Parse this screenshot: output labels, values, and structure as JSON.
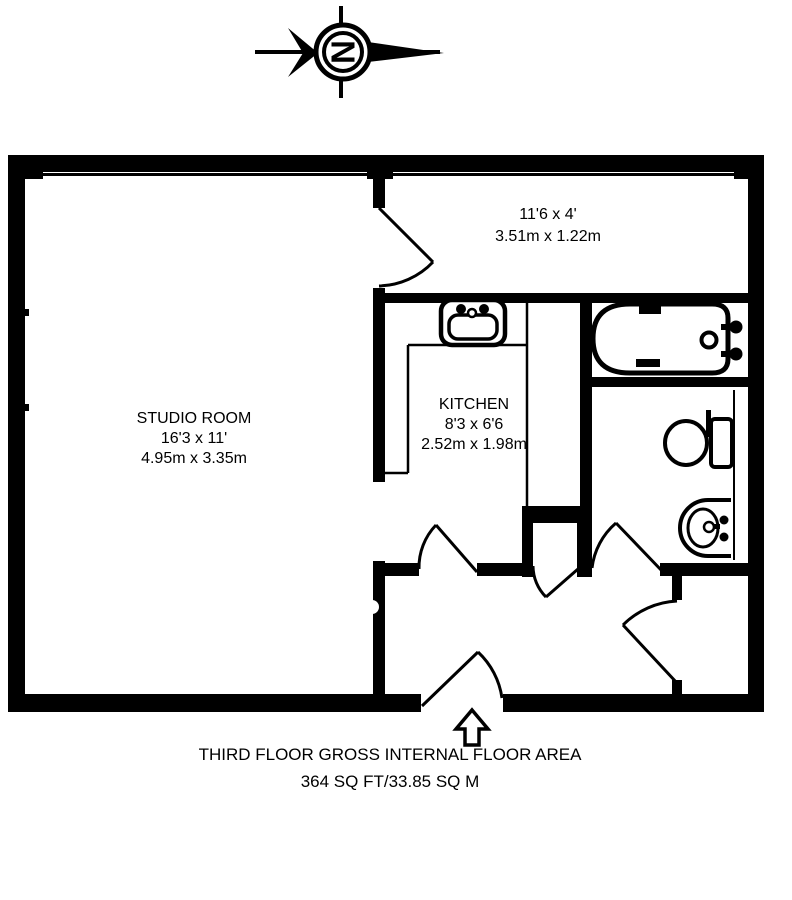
{
  "compass": {
    "letter": "N"
  },
  "rooms": {
    "studio": {
      "name": "STUDIO ROOM",
      "imperial": "16'3 x 11'",
      "metric": "4.95m x 3.35m"
    },
    "hallway": {
      "imperial": "11'6 x 4'",
      "metric": "3.51m x 1.22m"
    },
    "kitchen": {
      "name": "KITCHEN",
      "imperial": "8'3 x 6'6",
      "metric": "2.52m x 1.98m"
    }
  },
  "footer": {
    "line1": "THIRD FLOOR GROSS INTERNAL FLOOR AREA",
    "line2": "364 SQ FT/33.85 SQ M"
  },
  "colors": {
    "ink": "#000000",
    "background": "#ffffff"
  },
  "icons": {
    "compass": "north-compass-icon",
    "sink": "kitchen-sink-icon",
    "bath": "bathtub-icon",
    "toilet": "toilet-icon",
    "basin": "wash-basin-icon",
    "entrance": "entrance-arrow-icon"
  }
}
